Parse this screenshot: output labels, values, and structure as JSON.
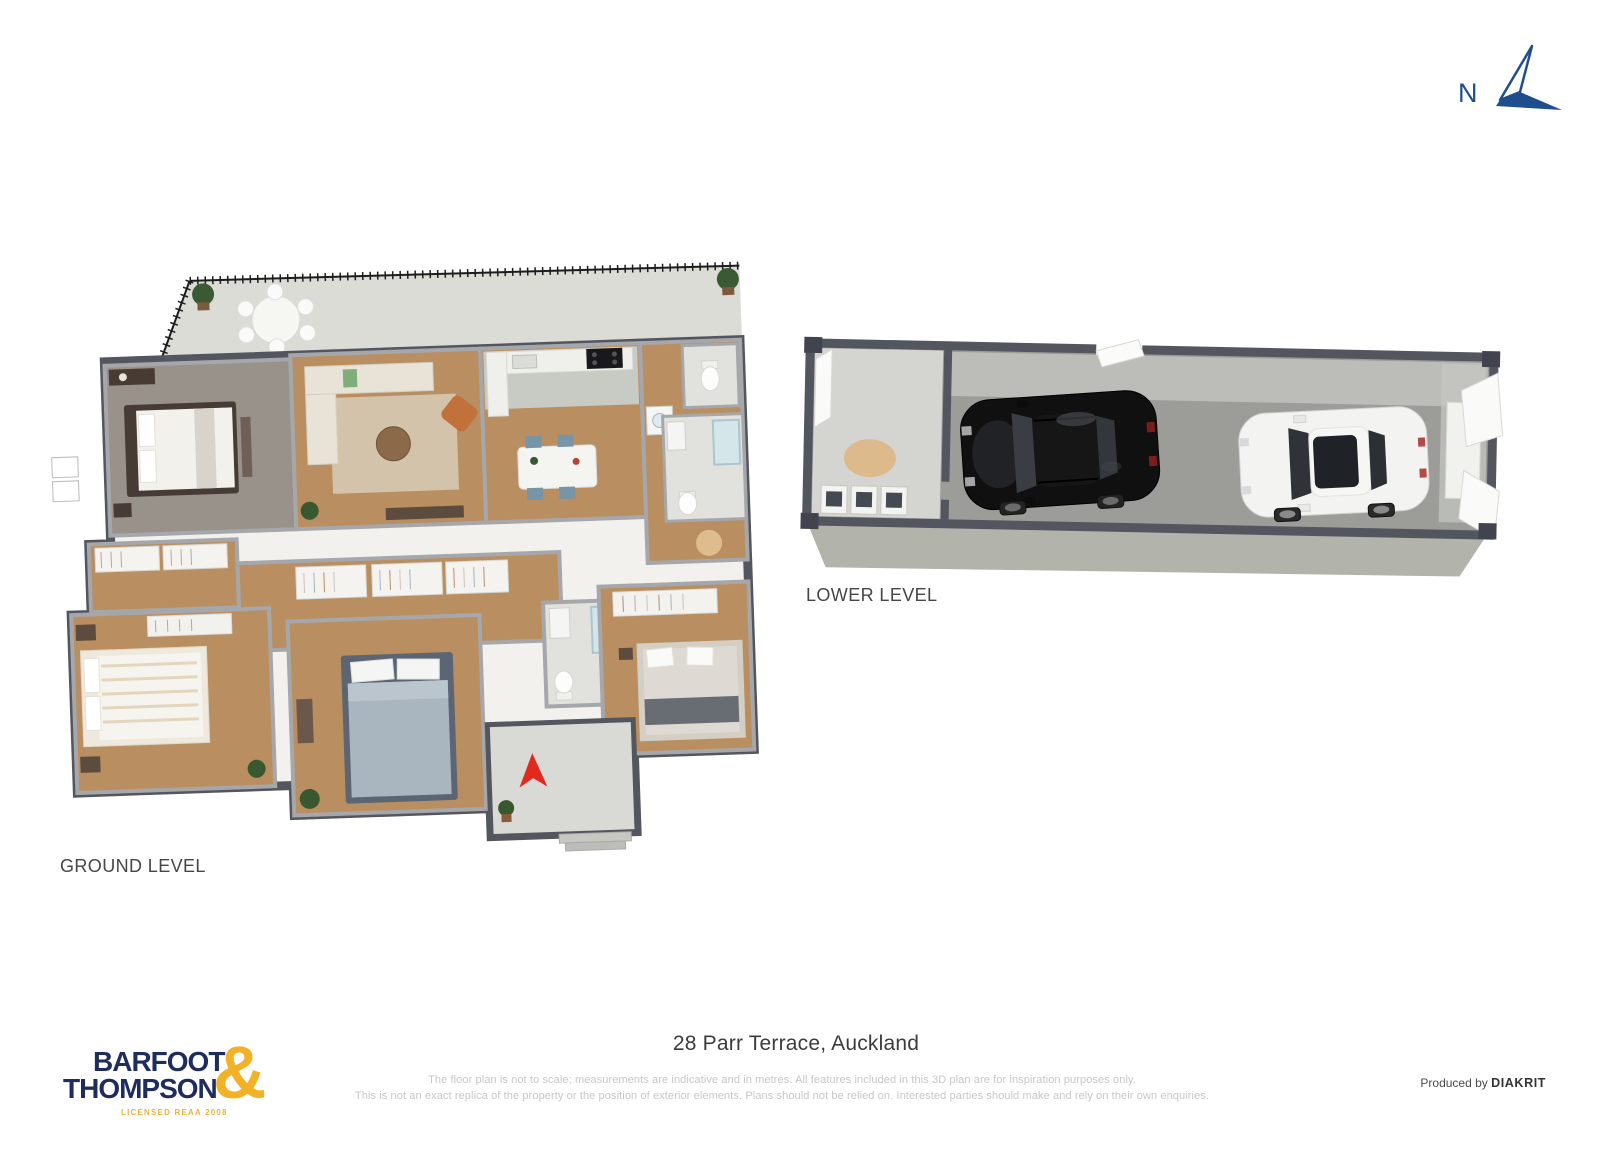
{
  "compass": {
    "label": "N"
  },
  "levels": {
    "ground_label": "GROUND LEVEL",
    "lower_label": "LOWER LEVEL"
  },
  "logo": {
    "line1": "BARFOOT",
    "line2": "THOMPSON",
    "ampersand": "&",
    "tagline": "LICENSED REAA 2008"
  },
  "footer": {
    "address": "28 Parr Terrace, Auckland",
    "disclaimer_line1": "The floor plan is not to scale; measurements are indicative and in metres. All features included in this 3D plan are for inspiration purposes only.",
    "disclaimer_line2": "This is not an exact replica of the property or the position of exterior elements. Plans should not be relied on. Interested parties should make and rely on their own enquiries.",
    "produced_by_label": "Produced by",
    "producer_name": "DIAKRIT"
  },
  "colors": {
    "brand_navy": "#1e2c5e",
    "brand_gold": "#f2b228",
    "compass_blue": "#1f4e8e",
    "outer_wall": "#54565f",
    "inner_wall": "#a6a7ab",
    "wood_floor": "#b98e60",
    "carpet_floor": "#98928a",
    "tile_floor": "#e1e2de",
    "terrace_floor": "#dbdcd6",
    "garage_floor": "#9c9d99",
    "garage_face": "#b2b3ab",
    "entry_arrow_red": "#e3291d",
    "car_black": "#101010",
    "car_white": "#f3f3f1"
  }
}
